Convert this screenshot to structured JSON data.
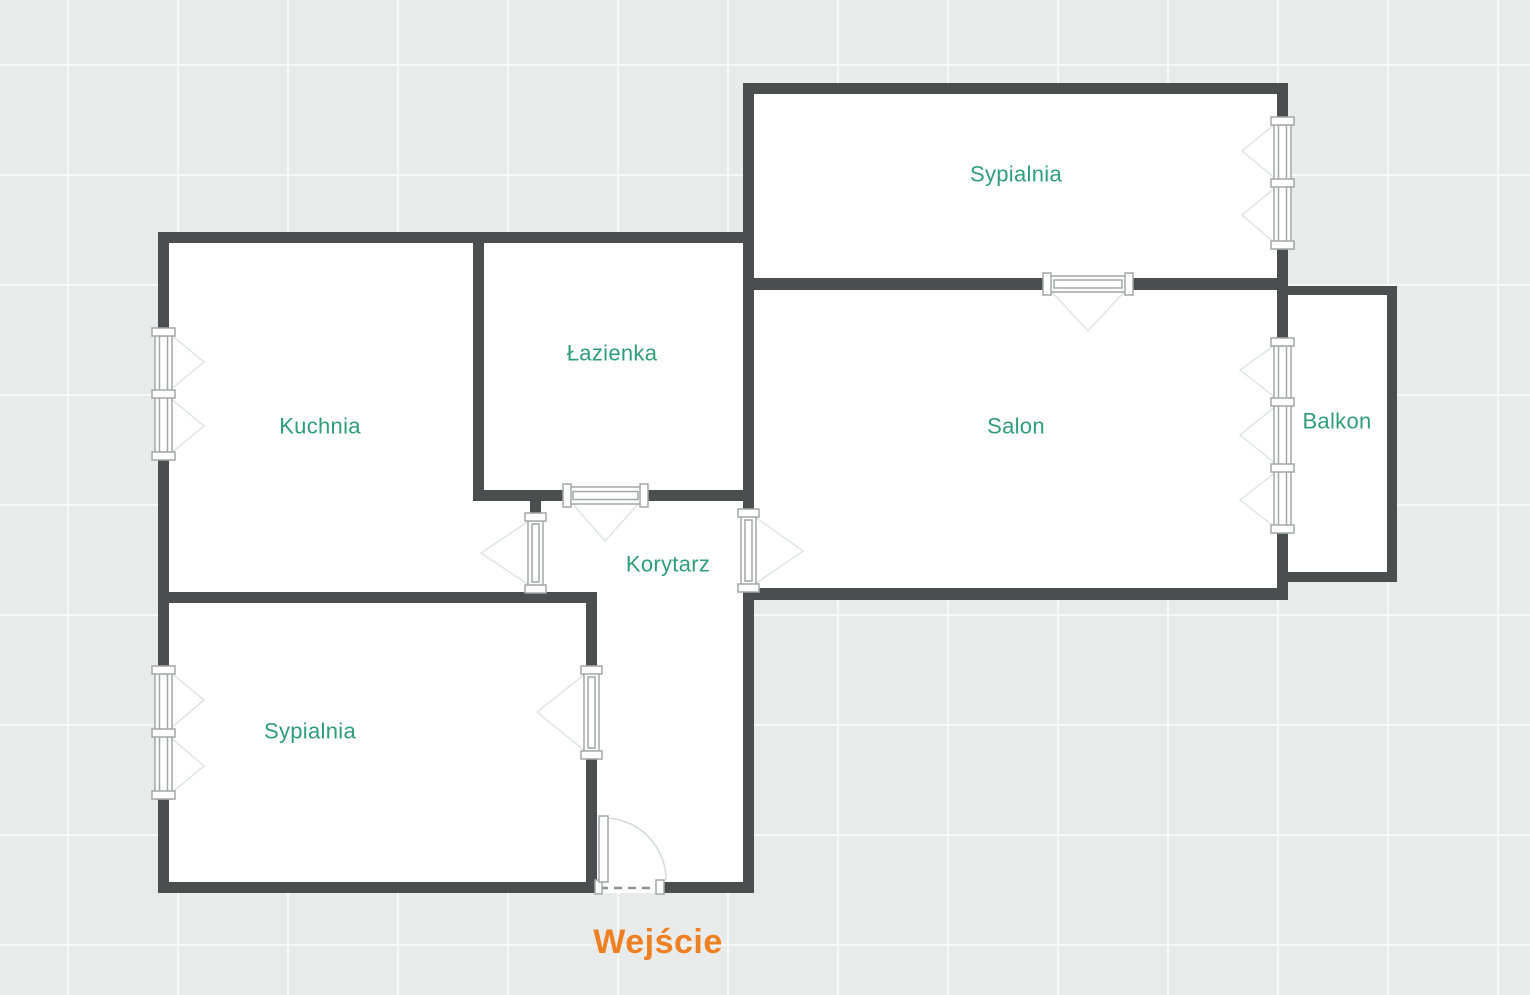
{
  "plan": {
    "colors": {
      "background": "#e9eaea",
      "grid_line": "#f7f8f8",
      "floor": "#ffffff",
      "wall": "#4a4e4e",
      "symbol_stroke": "#a2a7a7",
      "room_label": "#2f9d78",
      "entrance_label": "#ef8022",
      "threshold_dash": "#8d9292",
      "door_arc": "#d5d8d8"
    },
    "rooms": [
      {
        "id": "sypialnia-top",
        "label": "Sypialnia"
      },
      {
        "id": "lazienka",
        "label": "Łazienka"
      },
      {
        "id": "kuchnia",
        "label": "Kuchnia"
      },
      {
        "id": "salon",
        "label": "Salon"
      },
      {
        "id": "balkon",
        "label": "Balkon"
      },
      {
        "id": "korytarz",
        "label": "Korytarz"
      },
      {
        "id": "sypialnia-bottom",
        "label": "Sypialnia"
      }
    ],
    "entrance": {
      "label": "Wejście"
    }
  }
}
